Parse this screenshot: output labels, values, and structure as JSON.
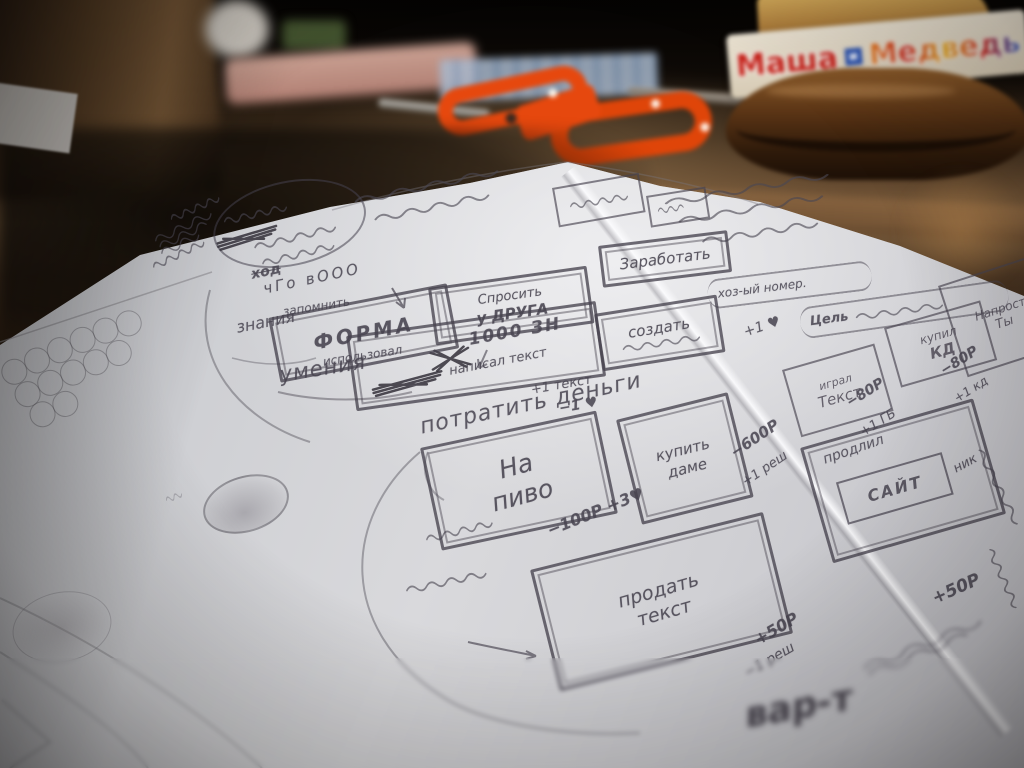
{
  "jar": {
    "label": {
      "part1": "Маша",
      "part2": "и",
      "part3": "Медведь"
    }
  },
  "sketch": {
    "left": {
      "hod": "ход",
      "cho": "чГо вООО",
      "zapomnit": "запомнить",
      "znania": "знания",
      "forma": "ФОРМА",
      "ispolzoval": "использовал",
      "umenia": "умения",
      "sprosit1": "Спросить",
      "sprosit2": "у ДРУГА"
    },
    "center": {
      "znaki": "1000 ЗН",
      "napisal": "написал текст",
      "plus_tekst": "+1 текст",
      "minus_heart": "−1 ♥",
      "potratit": "потратить деньги",
      "napivo1": "На",
      "napivo2": "пиво",
      "pivo_cost": "−100Р +3♥",
      "sozdat": "создать",
      "zarabotat": "Заработать",
      "nomer": "хоз-ый номер.",
      "plus_heart": "+1 ♥"
    },
    "right": {
      "tsel": "Цель",
      "igral": "играл",
      "tekst": "Текст",
      "kupit1": "купить",
      "kupit2": "даме",
      "kupit_cost1": "−600Р",
      "kupit_cost2": "+1 реш",
      "kupil1": "купил",
      "kupil2": "КД",
      "naprost1": "Напрост",
      "naprost2": "Ты",
      "kd1": "−80Р",
      "kd2": "+1 кд",
      "gb1": "−80Р",
      "gb2": "+1 ГБ",
      "prodlil1": "продлил",
      "prodlil2": "САЙТ",
      "prodlil3": "ник",
      "plus50": "+50Р"
    },
    "bottom": {
      "prodat1": "продать",
      "prodat2": "текст",
      "gain": "+50Р",
      "loss": "−1 реш",
      "vart": "вар-т"
    }
  }
}
